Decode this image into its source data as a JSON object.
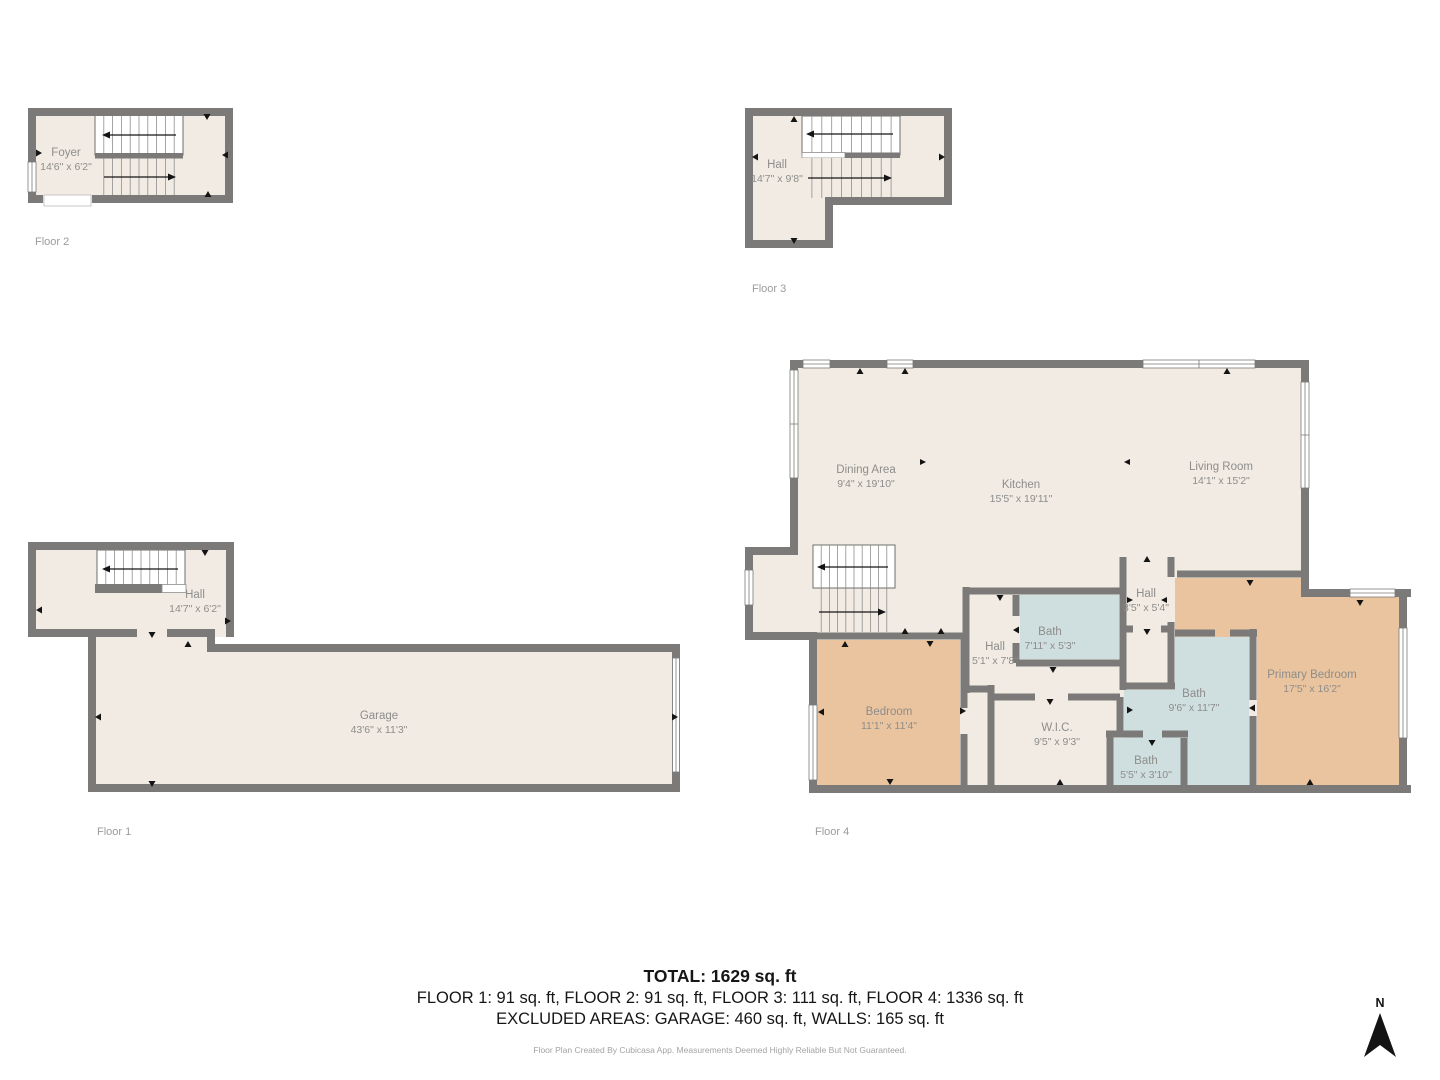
{
  "colors": {
    "wall": "#7b7a78",
    "floor": "#f2ebe3",
    "bedroom_fill": "#eac49f",
    "bath_fill": "#cfdfdf",
    "room_label": "#8d8d8b",
    "floor_label": "#9b9b9b",
    "north_arrow": "#141414"
  },
  "floors": [
    {
      "label": "Floor 2",
      "rooms": [
        {
          "name": "Foyer",
          "dims": "14'6\" x 6'2\""
        }
      ]
    },
    {
      "label": "Floor 3",
      "rooms": [
        {
          "name": "Hall",
          "dims": "14'7\" x 9'8\""
        }
      ]
    },
    {
      "label": "Floor 1",
      "rooms": [
        {
          "name": "Hall",
          "dims": "14'7\" x 6'2\""
        },
        {
          "name": "Garage",
          "dims": "43'6\" x 11'3\""
        }
      ]
    },
    {
      "label": "Floor 4",
      "rooms": [
        {
          "name": "Dining Area",
          "dims": "9'4\" x 19'10\""
        },
        {
          "name": "Kitchen",
          "dims": "15'5\" x 19'11\""
        },
        {
          "name": "Living Room",
          "dims": "14'1\" x 15'2\""
        },
        {
          "name": "Hall",
          "dims": "3'5\" x 5'4\""
        },
        {
          "name": "Bath",
          "dims": "7'11\" x 5'3\""
        },
        {
          "name": "Hall",
          "dims": "5'1\" x 7'8\""
        },
        {
          "name": "Bedroom",
          "dims": "11'1\" x 11'4\""
        },
        {
          "name": "W.I.C.",
          "dims": "9'5\" x 9'3\""
        },
        {
          "name": "Bath",
          "dims": "9'6\" x 11'7\""
        },
        {
          "name": "Bath",
          "dims": "5'5\" x 3'10\""
        },
        {
          "name": "Primary Bedroom",
          "dims": "17'5\" x 16'2\""
        }
      ]
    }
  ],
  "summary": {
    "total": "TOTAL: 1629 sq. ft",
    "floors_line": "FLOOR 1: 91 sq. ft, FLOOR 2: 91 sq. ft, FLOOR 3: 111 sq. ft, FLOOR 4: 1336 sq. ft",
    "excluded_line": "EXCLUDED AREAS: GARAGE: 460 sq. ft, WALLS: 165 sq. ft",
    "disclaimer": "Floor Plan Created By Cubicasa App. Measurements Deemed Highly Reliable But Not Guaranteed."
  },
  "compass": {
    "label": "N"
  }
}
